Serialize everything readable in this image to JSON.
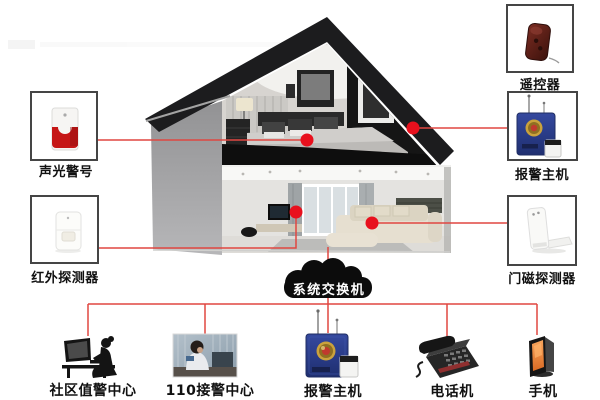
{
  "nodes": {
    "siren": {
      "label": "声光警号"
    },
    "pir": {
      "label": "红外探测器"
    },
    "remote": {
      "label": "遥控器"
    },
    "host_right": {
      "label": "报警主机"
    },
    "door": {
      "label": "门磁探测器"
    },
    "hub": {
      "label": "系统交换机"
    },
    "community": {
      "label": "社区值警中心"
    },
    "police110": {
      "label": "110接警中心"
    },
    "host_bottom": {
      "label": "报警主机"
    },
    "phone": {
      "label": "电话机"
    },
    "mobile": {
      "label": "手机"
    }
  },
  "colors": {
    "connector": "#e04741",
    "dot": "#e8101d",
    "cloud": "#0c0c0c",
    "cloud_text": "#ffffff",
    "box_border": "#454545",
    "label_text": "#111111",
    "host_blue": "#2c3f8e",
    "siren_red": "#c61616",
    "screen_orange": "#e8813c"
  }
}
